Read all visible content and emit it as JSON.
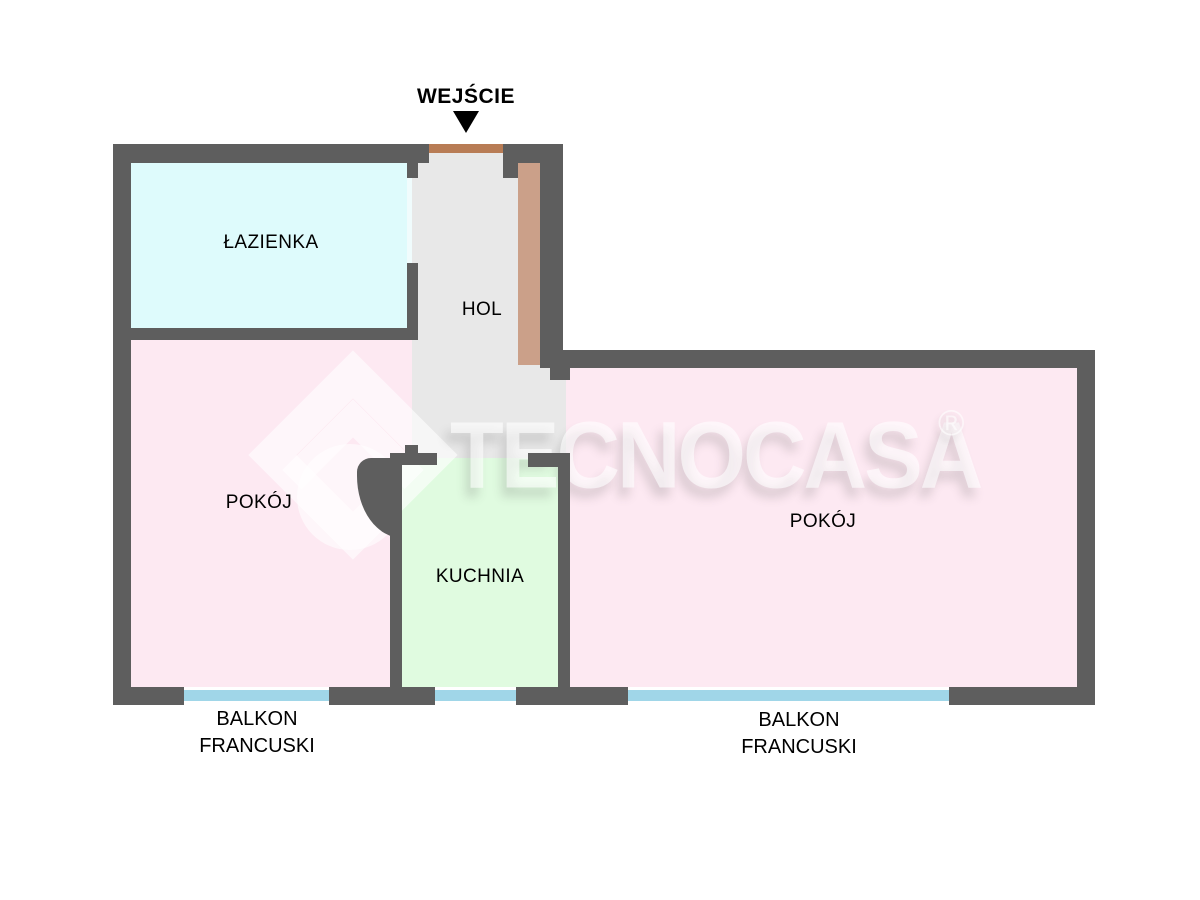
{
  "entrance": {
    "label": "WEJŚCIE"
  },
  "rooms": {
    "lazienka": {
      "label": "ŁAZIENKA"
    },
    "hol": {
      "label": "HOL"
    },
    "pokoj_left": {
      "label": "POKÓJ"
    },
    "kuchnia": {
      "label": "KUCHNIA"
    },
    "pokoj_right": {
      "label": "POKÓJ"
    }
  },
  "balconies": {
    "left": {
      "line1": "BALKON",
      "line2": "FRANCUSKI"
    },
    "right": {
      "line1": "BALKON",
      "line2": "FRANCUSKI"
    }
  },
  "watermark": {
    "brand": "TECNOCASA",
    "registered": "®"
  },
  "colors": {
    "wall": "#5e5e5e",
    "bathroom_floor": "#defbfc",
    "bathroom_door_opening": "#f0fcfd",
    "room_floor": "#fde9f2",
    "kitchen_floor": "#e0fbe0",
    "hall_floor": "#e8e8e8",
    "wardrobe": "#cba089",
    "entrance_door": "#b87c55",
    "window": "#a0d6e8",
    "label_text": "#000000",
    "watermark": "#ffffff99"
  }
}
